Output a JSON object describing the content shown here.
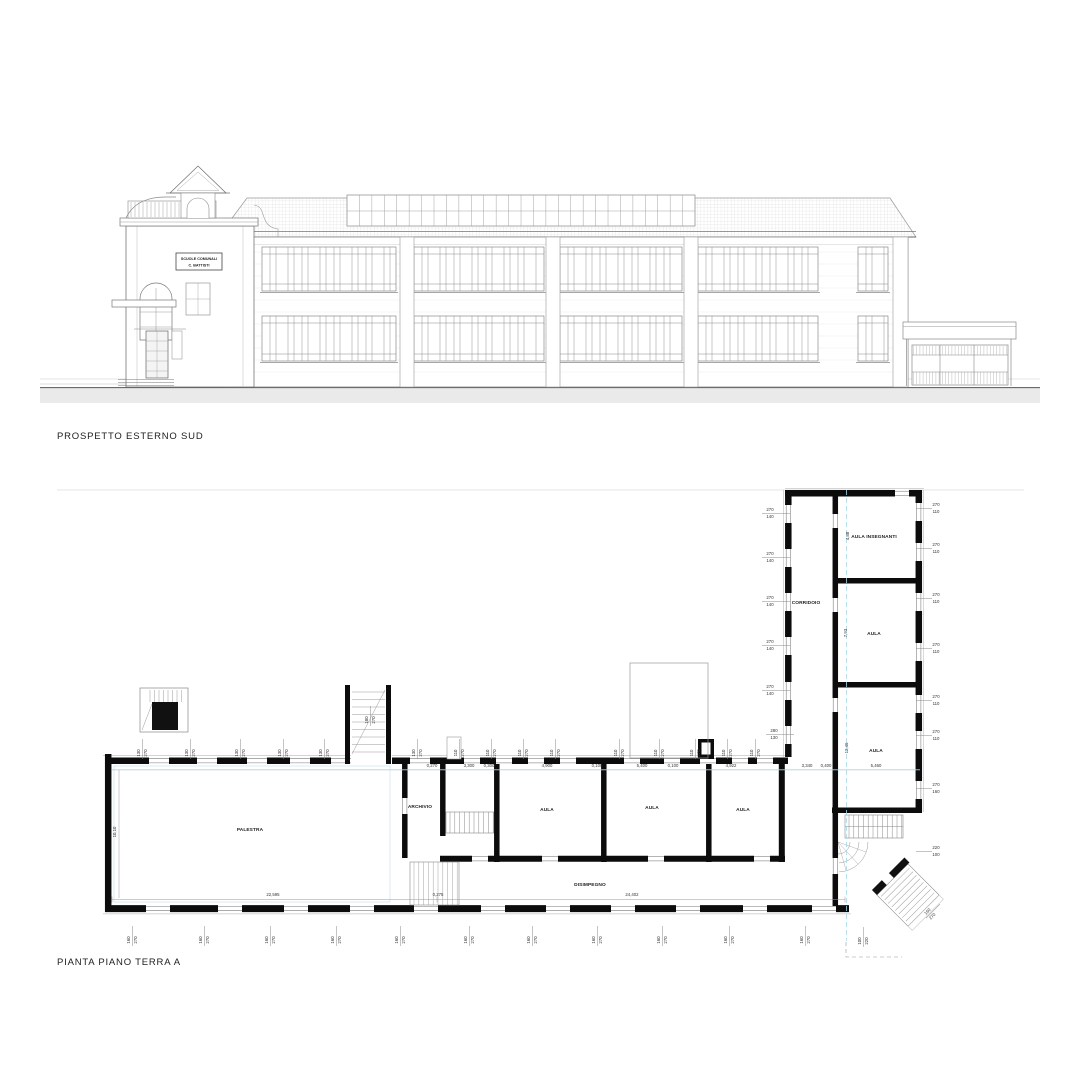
{
  "captions": {
    "elevation": "PROSPETTO ESTERNO SUD",
    "plan": "PIANTA PIANO TERRA A"
  },
  "elevation": {
    "sign_line1": "SCUOLE COMUNALI",
    "sign_line2": "C. BATTISTI"
  },
  "plan": {
    "room_labels": [
      {
        "t": "PALESTRA",
        "x": 250,
        "y": 831
      },
      {
        "t": "ARCHIVIO",
        "x": 420,
        "y": 808
      },
      {
        "t": "AULA",
        "x": 547,
        "y": 811
      },
      {
        "t": "AULA",
        "x": 652,
        "y": 809
      },
      {
        "t": "AULA",
        "x": 743,
        "y": 811
      },
      {
        "t": "DISIMPEGNO",
        "x": 590,
        "y": 886
      },
      {
        "t": "CORRIDOIO",
        "x": 806,
        "y": 604
      },
      {
        "t": "AULA INSEGNANTI",
        "x": 874,
        "y": 538
      },
      {
        "t": "AULA",
        "x": 874,
        "y": 635
      },
      {
        "t": "AULA",
        "x": 876,
        "y": 752
      }
    ],
    "width_dims": [
      {
        "t": "0,270",
        "x": 432
      },
      {
        "t": "3,300",
        "x": 469
      },
      {
        "t": "0,300",
        "x": 489
      },
      {
        "t": "4,900",
        "x": 547
      },
      {
        "t": "0,100",
        "x": 597
      },
      {
        "t": "5,400",
        "x": 642
      },
      {
        "t": "0,100",
        "x": 673
      },
      {
        "t": "4,922",
        "x": 731
      },
      {
        "t": "3,340",
        "x": 807
      },
      {
        "t": "0,400",
        "x": 826
      },
      {
        "t": "5,460",
        "x": 876
      }
    ],
    "bottom_dims": [
      {
        "t": "22,595",
        "x": 273,
        "y": 896
      },
      {
        "t": "0,275",
        "x": 438,
        "y": 896
      },
      {
        "t": "24,402",
        "x": 632,
        "y": 896
      }
    ],
    "vertical_dims": [
      {
        "t": "10,10",
        "x": 116,
        "y": 832
      },
      {
        "t": "4,88",
        "x": 849,
        "y": 536
      },
      {
        "t": "7,93",
        "x": 847,
        "y": 633
      },
      {
        "t": "12,46",
        "x": 848,
        "y": 748
      }
    ],
    "dim_pairs": [
      {
        "a": "270",
        "b": "140",
        "rot": 0,
        "pts": [
          [
            770,
            512
          ],
          [
            770,
            556
          ],
          [
            770,
            600
          ],
          [
            770,
            644
          ],
          [
            770,
            689
          ]
        ]
      },
      {
        "a": "280",
        "b": "130",
        "rot": 0,
        "pts": [
          [
            774,
            733
          ]
        ]
      },
      {
        "a": "270",
        "b": "110",
        "rot": 0,
        "pts": [
          [
            936,
            507
          ],
          [
            936,
            547
          ],
          [
            936,
            597
          ],
          [
            936,
            647
          ],
          [
            936,
            699
          ],
          [
            936,
            734
          ]
        ]
      },
      {
        "a": "270",
        "b": "160",
        "rot": 0,
        "pts": [
          [
            936,
            787
          ]
        ]
      },
      {
        "a": "220",
        "b": "100",
        "rot": 0,
        "pts": [
          [
            936,
            850
          ]
        ]
      },
      {
        "a": "130",
        "b": "270",
        "rot": -90,
        "pts": [
          [
            141,
            753
          ],
          [
            189,
            753
          ],
          [
            239,
            753
          ],
          [
            282,
            753
          ],
          [
            323,
            753
          ],
          [
            416,
            753
          ]
        ]
      },
      {
        "a": "180",
        "b": "270",
        "rot": -90,
        "pts": [
          [
            369,
            720
          ]
        ]
      },
      {
        "a": "110",
        "b": "270",
        "rot": -90,
        "pts": [
          [
            458,
            753
          ],
          [
            490,
            753
          ],
          [
            522,
            753
          ],
          [
            554,
            753
          ],
          [
            618,
            753
          ],
          [
            658,
            753
          ],
          [
            694,
            753
          ],
          [
            726,
            753
          ],
          [
            754,
            753
          ]
        ]
      },
      {
        "a": "160",
        "b": "270",
        "rot": -90,
        "pts": [
          [
            131,
            940
          ],
          [
            203,
            940
          ],
          [
            269,
            940
          ],
          [
            335,
            940
          ],
          [
            399,
            940
          ],
          [
            468,
            940
          ],
          [
            531,
            940
          ],
          [
            596,
            940
          ],
          [
            661,
            940
          ],
          [
            728,
            940
          ],
          [
            804,
            940
          ]
        ]
      },
      {
        "a": "100",
        "b": "220",
        "rot": -90,
        "pts": [
          [
            862,
            941
          ]
        ]
      },
      {
        "a": "160",
        "b": "270",
        "rot": -45,
        "pts": [
          [
            929,
            913
          ]
        ]
      }
    ]
  }
}
